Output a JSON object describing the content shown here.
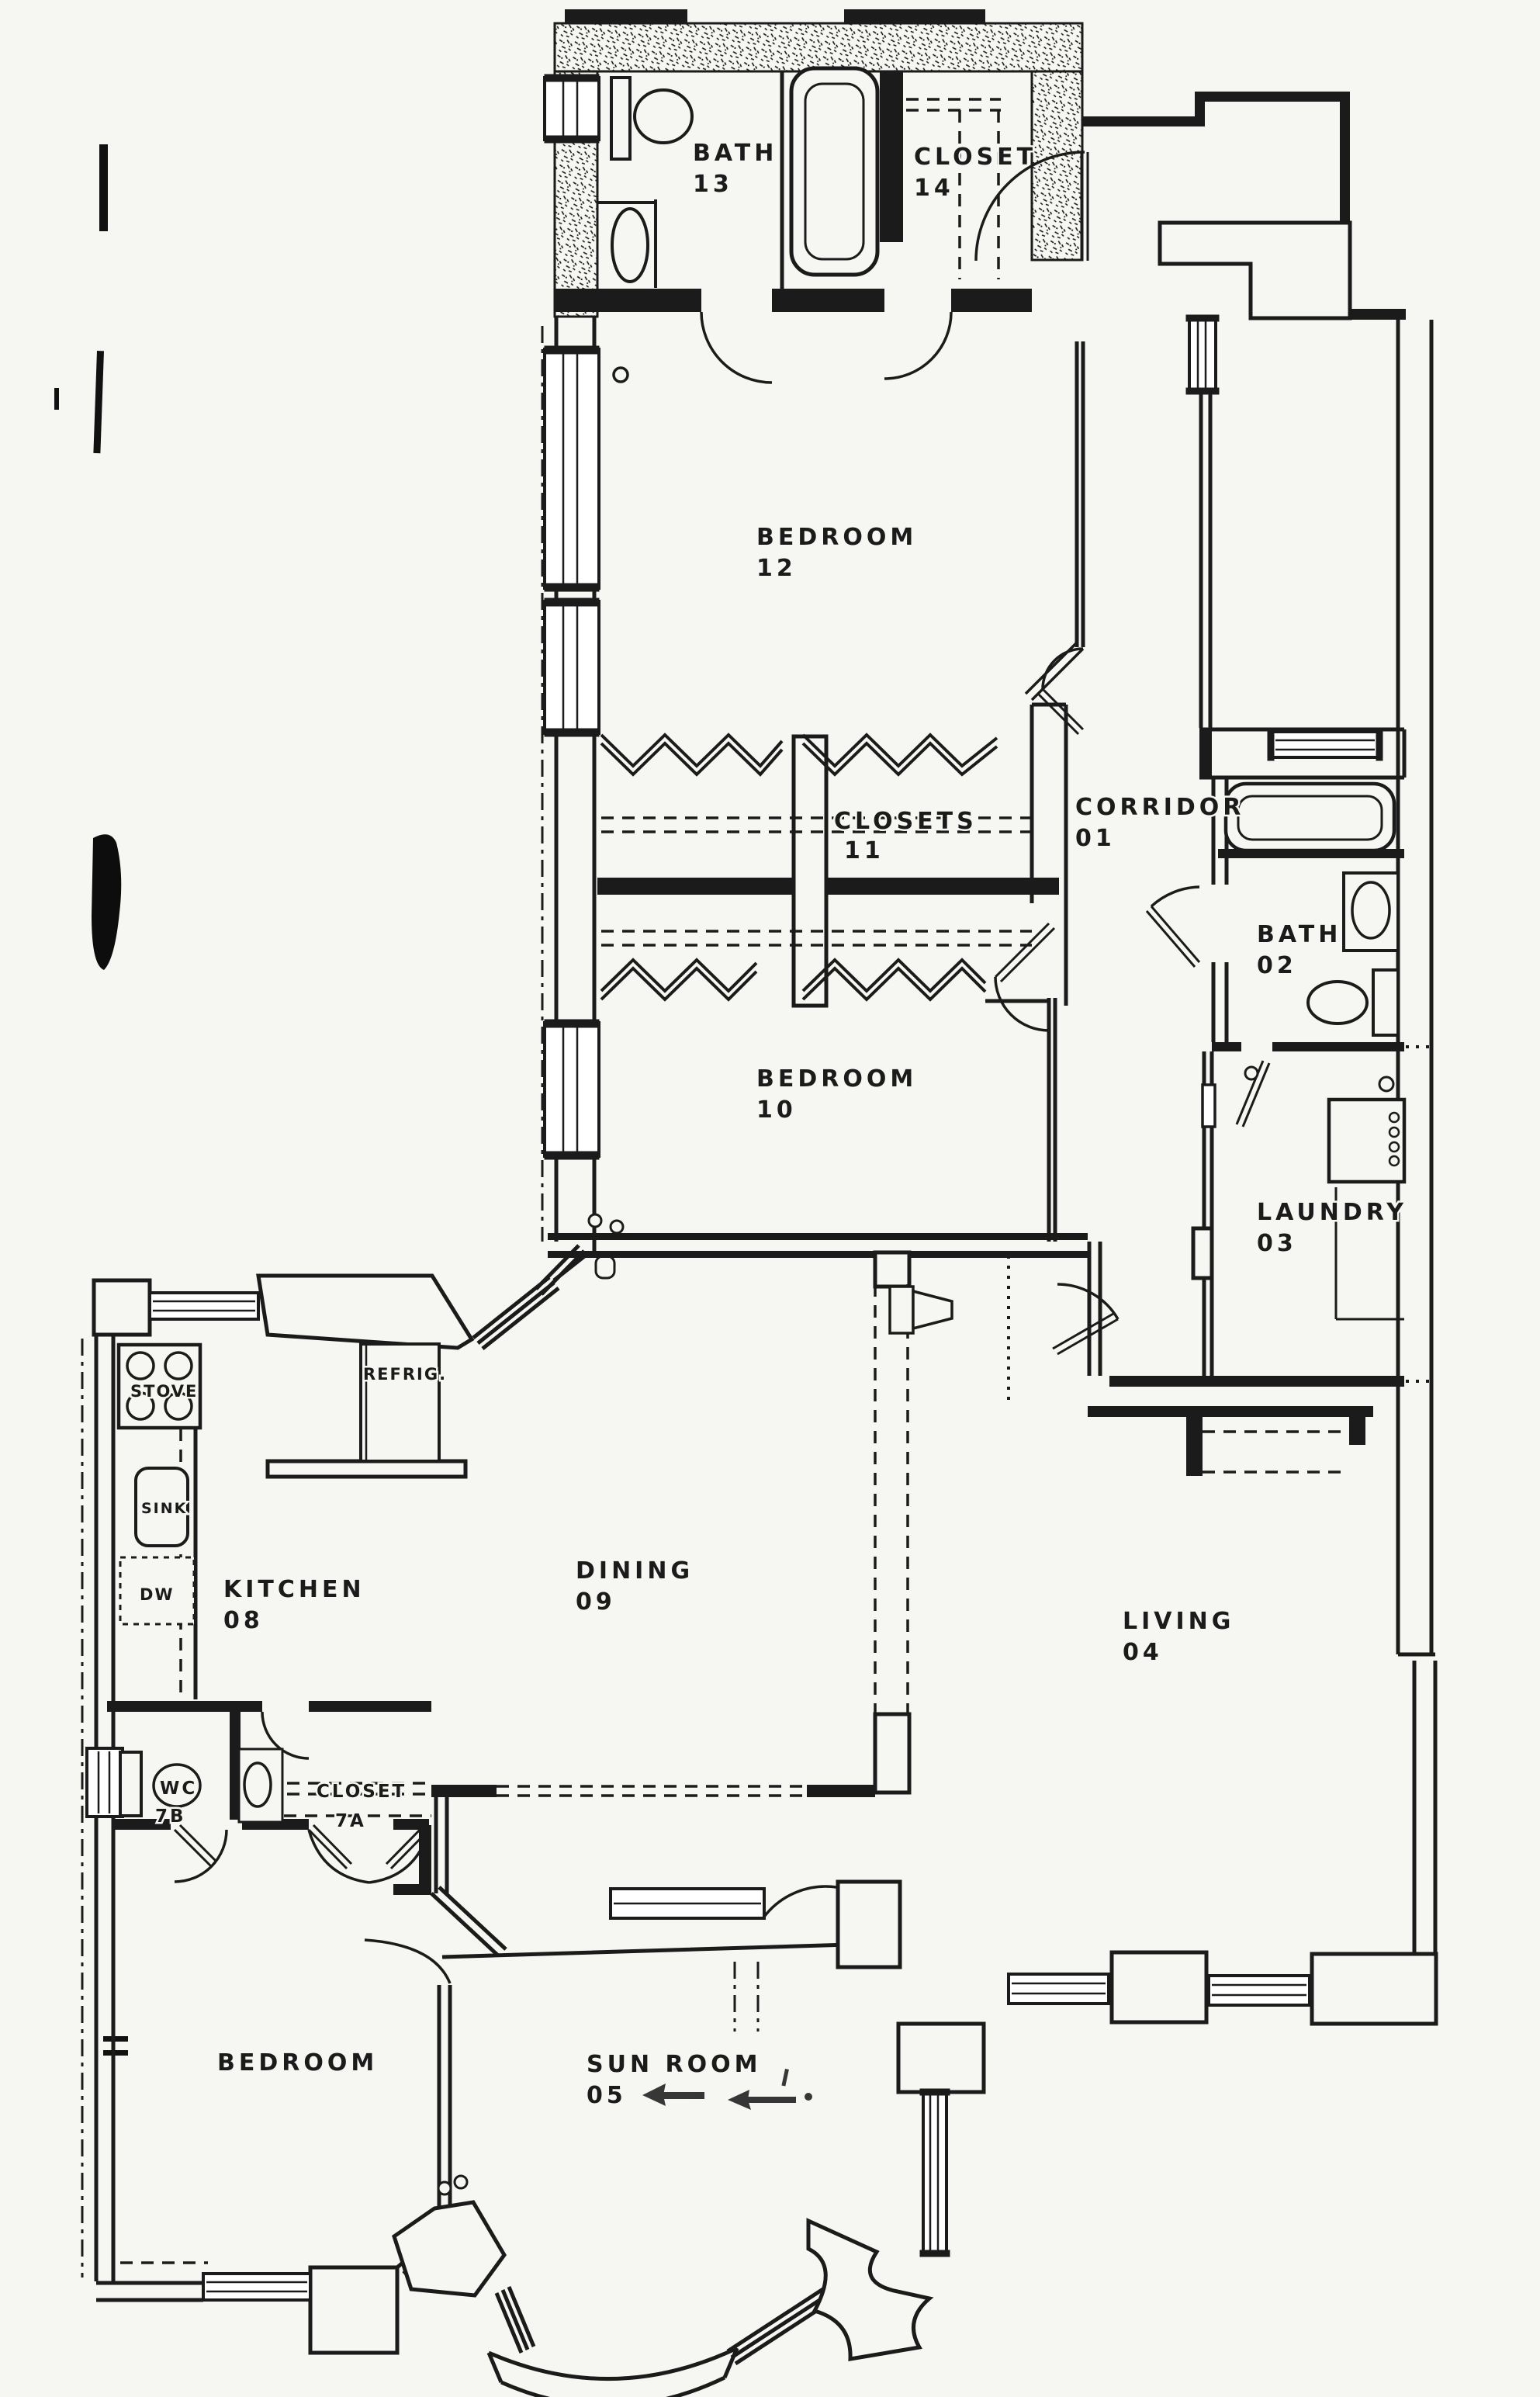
{
  "drawing_type": "apartment floor plan (scanned blueprint)",
  "ink_color": "#1b1b1b",
  "paper_color": "#f6f6f2",
  "labels": {
    "bath13": {
      "name": "BATH",
      "number": "13"
    },
    "closet14": {
      "name": "CLOSET",
      "number": "14"
    },
    "bedroom12": {
      "name": "BEDROOM",
      "number": "12"
    },
    "closets11": {
      "name": "CLOSETS",
      "number": "11"
    },
    "corridor01": {
      "name": "CORRIDOR",
      "number": "01"
    },
    "bath02": {
      "name": "BATH",
      "number": "02"
    },
    "bedroom10": {
      "name": "BEDROOM",
      "number": "10"
    },
    "laundry03": {
      "name": "LAUNDRY",
      "number": "03"
    },
    "kitchen08": {
      "name": "KITCHEN",
      "number": "08"
    },
    "dining09": {
      "name": "DINING",
      "number": "09"
    },
    "living04": {
      "name": "LIVING",
      "number": "04"
    },
    "wc7b": {
      "name": "WC",
      "number": "7B"
    },
    "closet7a": {
      "name": "CLOSET",
      "number": "7A"
    },
    "bedroom_sw": {
      "name": "BEDROOM",
      "number": ""
    },
    "sunroom05": {
      "name": "SUN  ROOM",
      "number": "05"
    }
  },
  "fixtures": {
    "stove": "STOVE",
    "refrigerator": "REFRIG.",
    "kitchen_sink": "SINK",
    "dishwasher": "DW"
  }
}
